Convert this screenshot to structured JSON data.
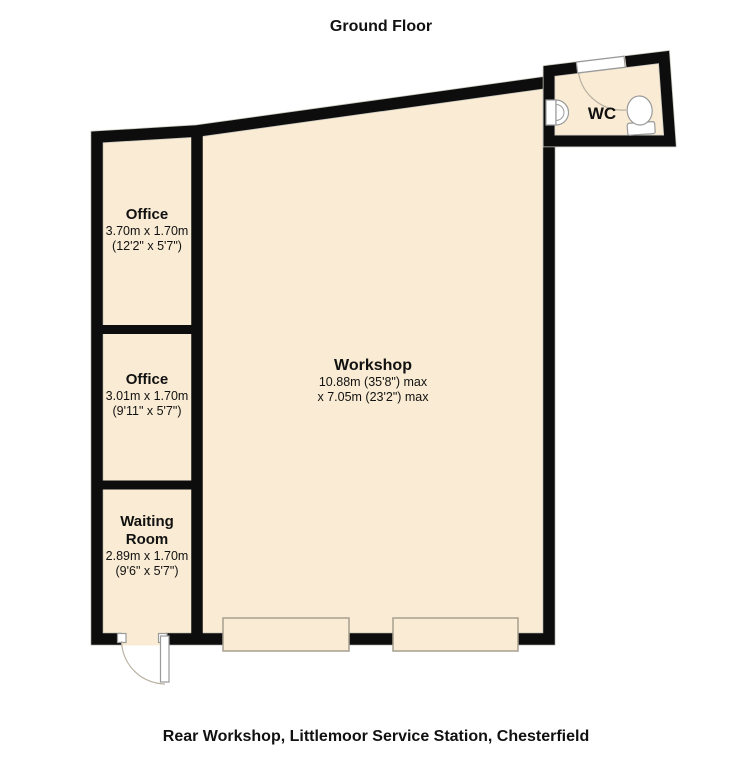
{
  "title": "Ground Floor",
  "caption": "Rear Workshop, Littlemoor Service Station, Chesterfield",
  "colors": {
    "background": "#ffffff",
    "floor": "#FAECD4",
    "wall": "#0D0D0D",
    "outline": "#C9C6BE",
    "fixture": "#9A9A9A",
    "door_arc": "#B9B1A2",
    "roller": "#A79E8F",
    "text": "#111111"
  },
  "rooms": {
    "office_top": {
      "name": "Office",
      "dims_metric": "3.70m x 1.70m",
      "dims_imperial": "(12'2\" x 5'7\")"
    },
    "office_middle": {
      "name": "Office",
      "dims_metric": "3.01m x 1.70m",
      "dims_imperial": "(9'11\" x 5'7\")"
    },
    "waiting_room": {
      "name": "Waiting Room",
      "dims_metric": "2.89m x 1.70m",
      "dims_imperial": "(9'6\" x 5'7\")"
    },
    "workshop": {
      "name": "Workshop",
      "dims_line1": "10.88m (35'8\") max",
      "dims_line2": "x 7.05m (23'2\") max"
    },
    "wc": {
      "name": "WC"
    }
  },
  "fixtures": {
    "toilet": "toilet-icon",
    "sink": "sink-icon",
    "wc_door": "door-swing-icon",
    "entrance_door": "door-swing-icon",
    "roller_door_left": "roller-door-icon",
    "roller_door_right": "roller-door-icon"
  }
}
